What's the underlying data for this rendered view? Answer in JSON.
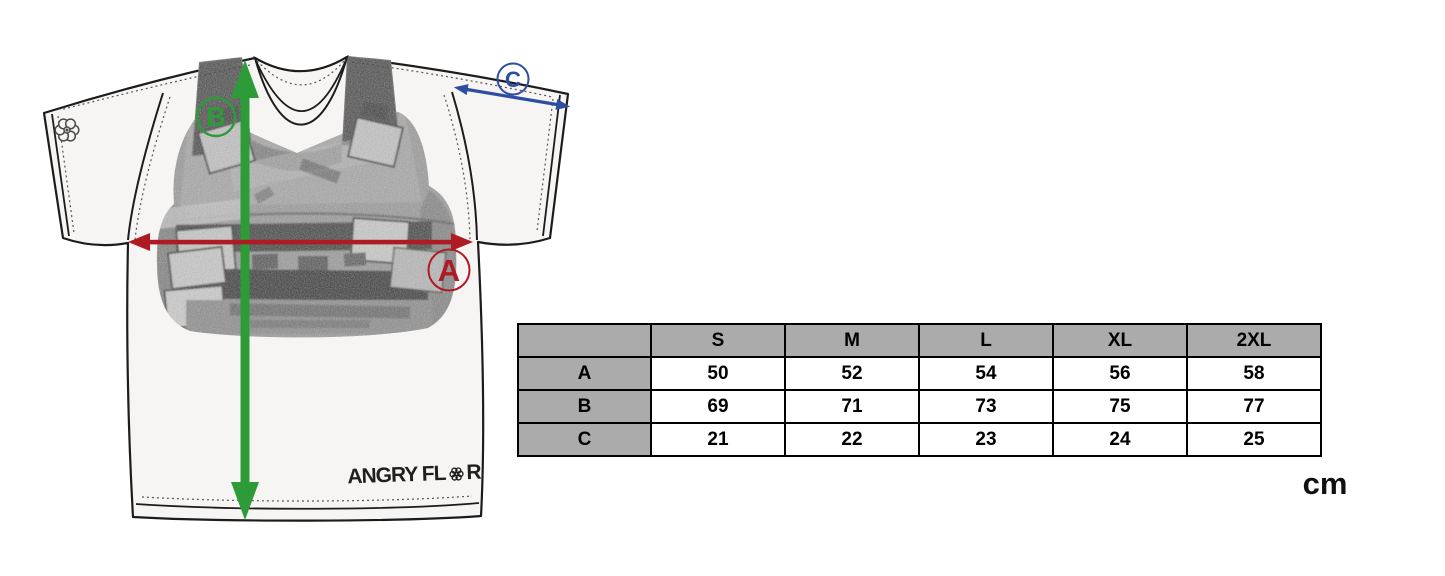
{
  "title": "T-shirt size guide",
  "unit_label": "cm",
  "brand": {
    "prefix": "ANGRY FL",
    "suffix": "R"
  },
  "icons": {
    "brand_o": "flower-icon",
    "sleeve_logo": "flower-icon"
  },
  "colors": {
    "measure_a_red": "#ae1b22",
    "measure_b_green": "#2d9b38",
    "measure_c_blue": "#2e4da1",
    "table_header_bg": "#ababab",
    "table_border": "#000000",
    "shirt_fill": "#f6f5f4",
    "outline": "#1c1c1c"
  },
  "measurements": {
    "a": {
      "label": "A"
    },
    "b": {
      "label": "B"
    },
    "c": {
      "label": "C"
    }
  },
  "size_chart": {
    "columns": [
      "S",
      "M",
      "L",
      "XL",
      "2XL"
    ],
    "rows": [
      {
        "label": "A",
        "values": [
          "50",
          "52",
          "54",
          "56",
          "58"
        ]
      },
      {
        "label": "B",
        "values": [
          "69",
          "71",
          "73",
          "75",
          "77"
        ]
      },
      {
        "label": "C",
        "values": [
          "21",
          "22",
          "23",
          "24",
          "25"
        ]
      }
    ]
  }
}
